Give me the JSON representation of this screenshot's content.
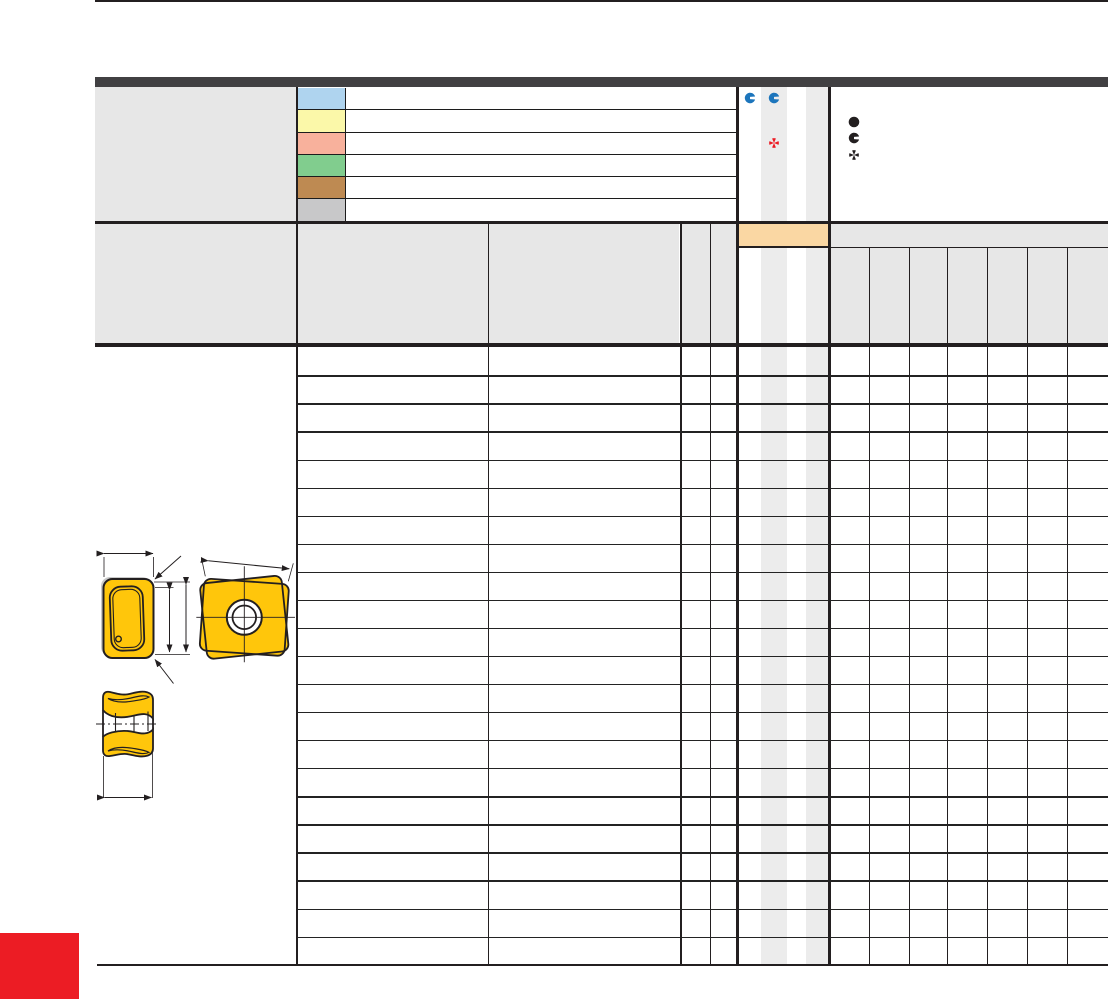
{
  "document": {
    "kind": "catalog-insert-table-page",
    "notes": "page shows an empty-text tooling catalog table: legend with six color swatches, marker icon columns, a three-symbol key, a 22-row spec table with an orange highlighted header cell, gold insert technical drawings and a red corner block"
  },
  "colors": {
    "page-bg": "#FFFFFF",
    "top-bar": "#414042",
    "line": "#231F20",
    "header-bg": "#E7E7E7",
    "panel-bg": "#E7E7E7",
    "stripe": "#ECECEC",
    "orange-highlight": "#FAD7A3",
    "icon-blue": "#1C75BC",
    "icon-red": "#EC1C24",
    "icon-black": "#231F20",
    "insert-gold": "#FFC60B",
    "red-square": "#EC1C24"
  },
  "legend": {
    "swatches": [
      {
        "name": "swatch-blue",
        "color": "#AFD4EF"
      },
      {
        "name": "swatch-yellow",
        "color": "#FBF8A9"
      },
      {
        "name": "swatch-salmon",
        "color": "#F8B19C"
      },
      {
        "name": "swatch-green",
        "color": "#81CD8E"
      },
      {
        "name": "swatch-brown",
        "color": "#BE8A52"
      },
      {
        "name": "swatch-gray",
        "color": "#C8C8C9"
      }
    ],
    "marker_columns": [
      {
        "icon": "pacman-icon",
        "color": "#1C75BC"
      },
      {
        "icon": "pacman-icon",
        "color": "#1C75BC"
      },
      {
        "icon": "four-wedge-star-icon",
        "color": "#EC1C24"
      }
    ],
    "symbol_key": [
      {
        "icon": "filled-circle-icon",
        "color": "#231F20"
      },
      {
        "icon": "pacman-icon",
        "color": "#231F20"
      },
      {
        "icon": "four-wedge-star-icon",
        "color": "#231F20"
      }
    ]
  },
  "table": {
    "header": {
      "left_columns": 5,
      "marker_subcolumns": 4,
      "right_subcolumns": 7,
      "orange_highlight_cell": true
    },
    "body": {
      "row_count": 22
    }
  }
}
